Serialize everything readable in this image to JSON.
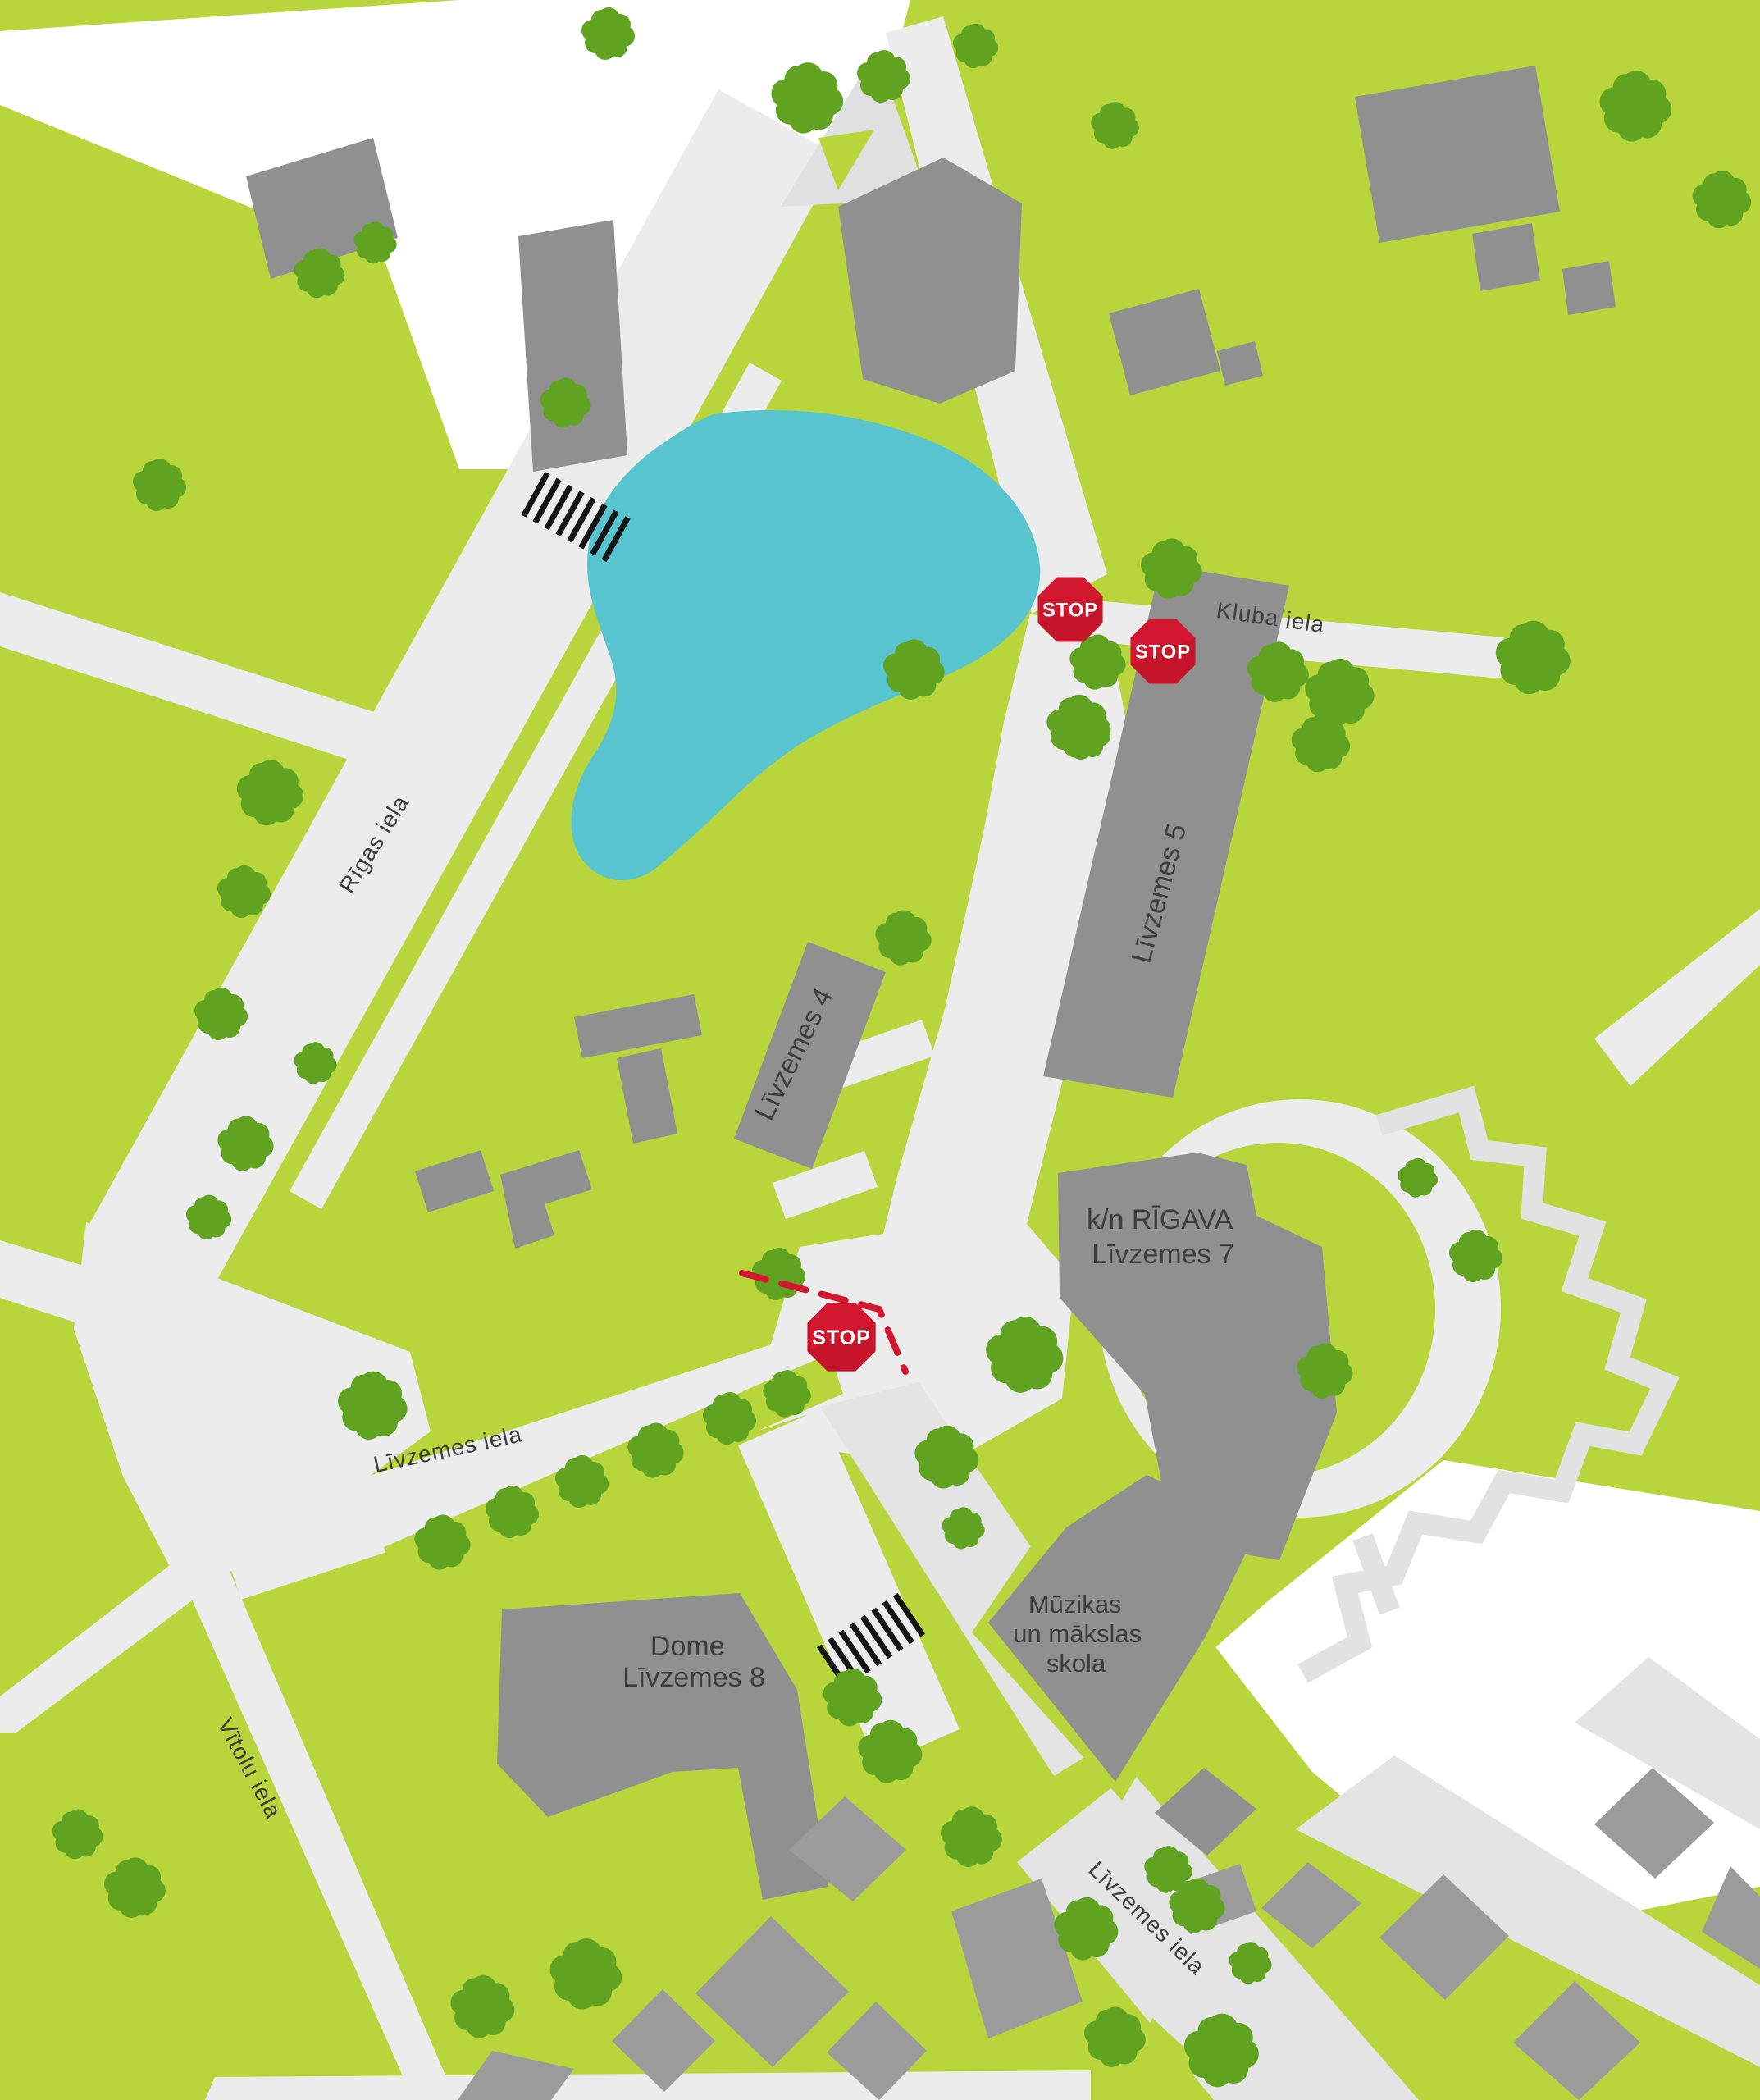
{
  "map": {
    "streets": [
      {
        "name": "Rīgas iela"
      },
      {
        "name": "Kluba iela"
      },
      {
        "name": "Līvzemes iela"
      },
      {
        "name": "Vītolu iela"
      },
      {
        "name": "Līvzemes iela"
      }
    ],
    "buildings": [
      {
        "name": "Līvzemes 5"
      },
      {
        "name": "Līvzemes 4"
      },
      {
        "lines": [
          "k/n RĪGAVA",
          "Līvzemes 7"
        ]
      },
      {
        "lines": [
          "Dome",
          "Līvzemes 8"
        ]
      },
      {
        "lines": [
          "Mūzikas",
          "un mākslas",
          "skola"
        ]
      }
    ],
    "stop_signs": [
      {
        "label": "STOP"
      },
      {
        "label": "STOP"
      },
      {
        "label": "STOP"
      }
    ],
    "palette": {
      "grass": "#b8d63c",
      "tree_green": "#60a321",
      "road": "#ececec",
      "road_secondary": "#e4e4e4",
      "building_gray": "#909090",
      "building_gray_dark": "#9b9b9b",
      "water_cyan": "#58c4d0",
      "plaza_white": "#ffffff",
      "stop_red": "#d2182e",
      "label_text": "#3d3d3d",
      "crosswalk_black": "#151515"
    }
  }
}
